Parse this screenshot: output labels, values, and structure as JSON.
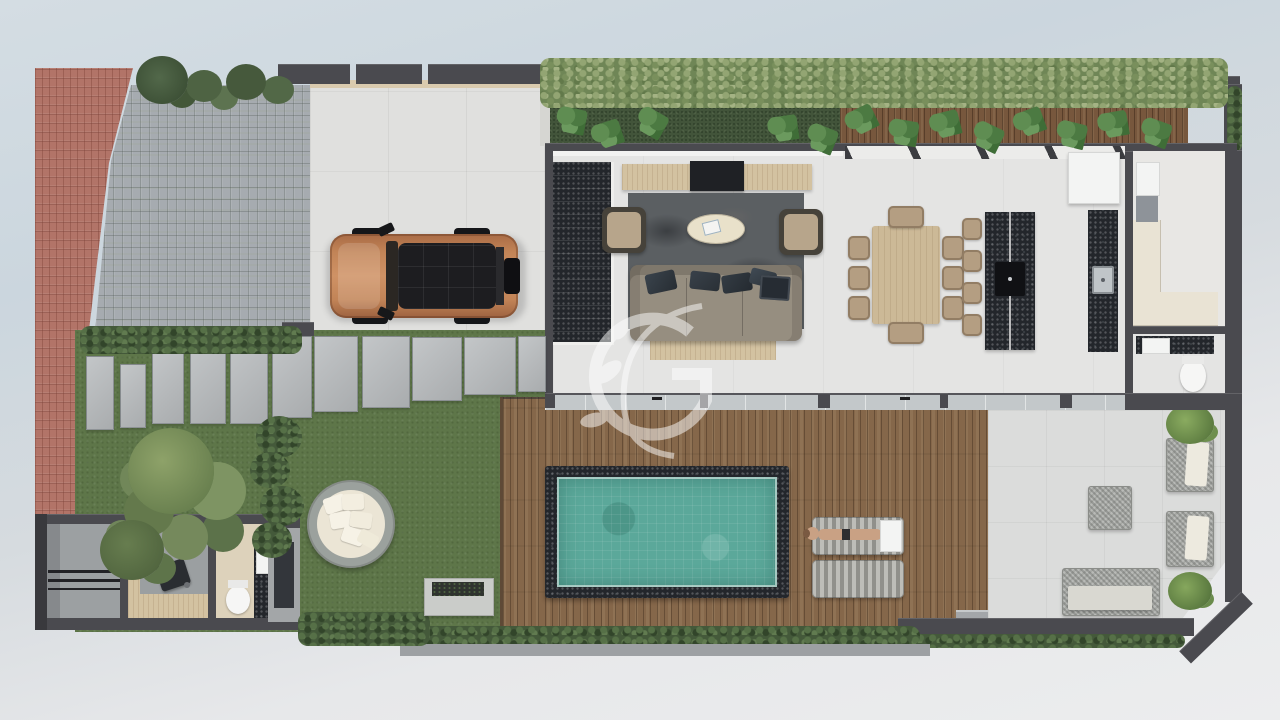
{
  "scene": {
    "description": "Top-down 3D rendered floor plan of a narrow villa lot with driveway, lawn garden, pool deck and rear patio",
    "watermark": {
      "letter": "G"
    },
    "palette": {
      "background_top": "#cdd7de",
      "background_bottom": "#ecedee",
      "wall_dark": "#4a4a4f",
      "brick_sidewalk": "#b27468",
      "cobblestone": "#a6abb0",
      "concrete_driveway": "#e0e0de",
      "lawn_green": "#5e7649",
      "hedge_green": "#6f8656",
      "deck_wood": "#85674a",
      "pool_water": "#5ba89a",
      "granite_dark": "#23262b",
      "car_copper": "#c28457",
      "car_roof_black": "#1d1d20",
      "patio_concrete": "#dbdcdb",
      "cushion_cream": "#ebe5d5"
    },
    "areas": {
      "sidewalk": {
        "label": "red brick sidewalk strip"
      },
      "entry_court": {
        "label": "grey cobblestone entry court with ferns"
      },
      "driveway": {
        "label": "concrete driveway",
        "vehicle": "copper SUV with black roof and rear spare wheel"
      },
      "garden": {
        "label": "lawn garden",
        "features": [
          "stepping stone path",
          "large trees",
          "bush row",
          "round wicker daybed with white cushions",
          "concrete planter box"
        ]
      },
      "service_block": {
        "label": "outdoor service block",
        "features": [
          "side gate",
          "slatted grate",
          "grill",
          "wc with toilet and vanity sink",
          "roof slab with skylight"
        ]
      },
      "house": {
        "living_room": [
          "dark stone staircase",
          "wood tv console",
          "tv",
          "dark marble rug",
          "two tan armchairs",
          "oval cream coffee table",
          "grey three-seat sofa with dark cushions and laptop",
          "light wood mat"
        ],
        "dining_room": [
          "light wood dining table",
          "eight tan chairs"
        ],
        "kitchen": [
          "black granite island with cooktop",
          "four bar stools",
          "black granite wall counter with sink",
          "white fridge"
        ],
        "pantry_laundry": [
          "l-shaped cream counter",
          "white appliance",
          "grey appliance"
        ],
        "bathroom": [
          "black granite vanity with white sink",
          "toilet"
        ]
      },
      "green_buffer": {
        "label": "rear hedge, grass strip and timber planter with monstera plants"
      },
      "pool_deck": {
        "label": "timber pool deck",
        "features": [
          "pool with dark stone coping and teal water",
          "two striped sun loungers",
          "person sunbathing",
          "tray"
        ]
      },
      "patio": {
        "label": "rear concrete patio with angled corner",
        "features": [
          "wicker coffee table",
          "two wicker armchairs with cream cushions",
          "wicker bench",
          "two shrubs"
        ]
      }
    }
  }
}
